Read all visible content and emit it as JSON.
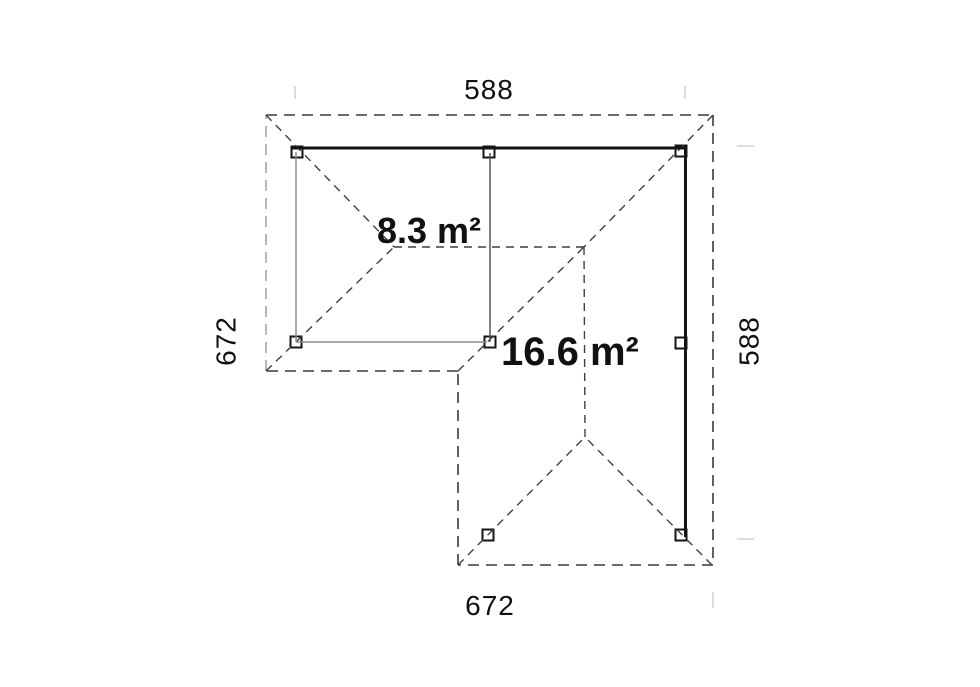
{
  "labels": {
    "dim_top": "588",
    "dim_bottom": "672",
    "dim_left": "672",
    "dim_right": "588",
    "area_small": "8.3 m²",
    "area_large": "16.6 m²"
  },
  "colors": {
    "ink": "#111111",
    "roof_outline_dark": "#3a3a3a",
    "roof_outline_gray": "#a6a6a6",
    "roof_ridge": "#3f3f3f",
    "beam_black": "#141414",
    "wall_light_gray": "#8c8c8c",
    "wall_mid_gray": "#4d4d4d",
    "post_stroke": "#141414",
    "witness_tick": "#d4d4d4"
  }
}
